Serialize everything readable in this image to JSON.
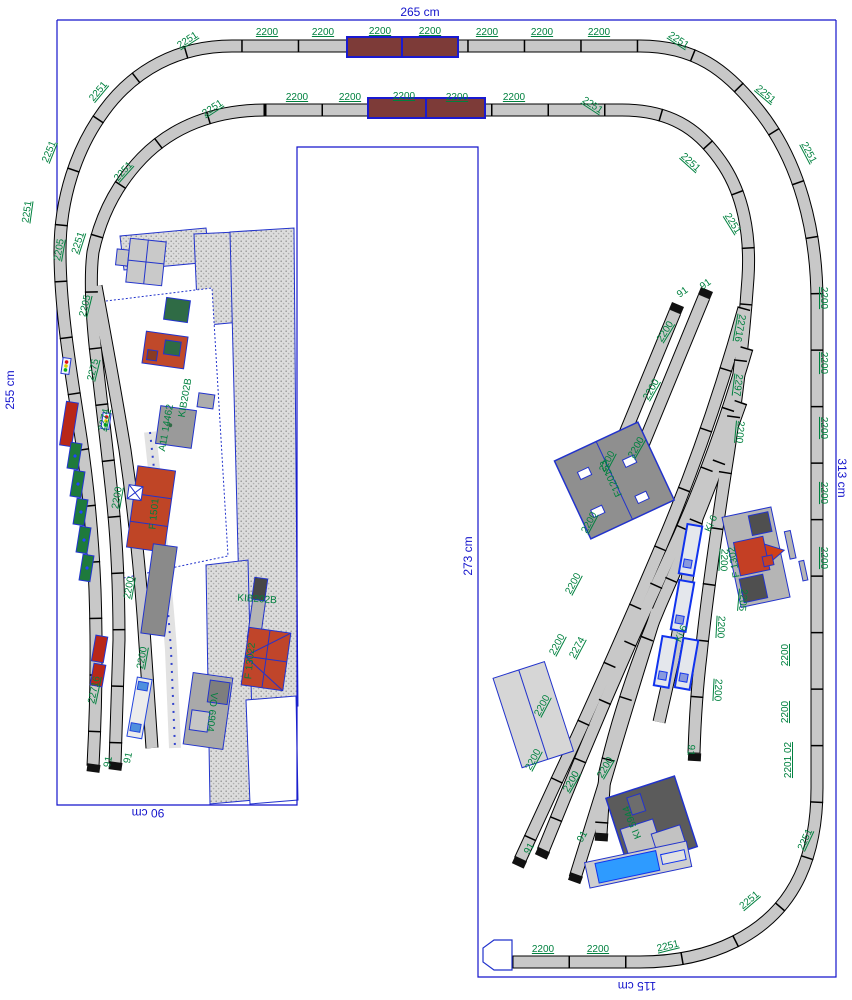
{
  "plan": {
    "name": "model-railroad-track-plan",
    "colors": {
      "border_blue": "#1414cc",
      "label_green": "#00813f",
      "track_gray": "#c8c8c8",
      "bridge_brown": "#7d3b38",
      "building_red": "#c0452a",
      "building_gray": "#9a9a9a",
      "building_dark": "#5b5b5b",
      "wagon_green": "#1e7a3c",
      "wagon_red": "#b92718",
      "loco_blue": "#2e9bff",
      "coach_outline_blue": "#1133ee"
    }
  },
  "dimensions": {
    "top": "265 cm",
    "left": "255 cm",
    "right": "313 cm",
    "bottom_left": "90 cm",
    "middle": "273 cm",
    "bottom": "115 cm"
  },
  "labels": [
    [
      "2200",
      267,
      33,
      0
    ],
    [
      "2200",
      323,
      33,
      0
    ],
    [
      "2200",
      380,
      32,
      0
    ],
    [
      "2200",
      430,
      32,
      0
    ],
    [
      "2200",
      487,
      33,
      0
    ],
    [
      "2200",
      542,
      33,
      0
    ],
    [
      "2200",
      599,
      33,
      0
    ],
    [
      "2251",
      188,
      41,
      -33
    ],
    [
      "2251",
      678,
      41,
      33
    ],
    [
      "2200",
      297,
      98,
      0
    ],
    [
      "2200",
      350,
      98,
      0
    ],
    [
      "2200",
      404,
      97,
      0
    ],
    [
      "2200",
      457,
      98,
      0
    ],
    [
      "2200",
      514,
      98,
      0
    ],
    [
      "2251",
      213,
      109,
      -33
    ],
    [
      "2251",
      592,
      106,
      33
    ],
    [
      "2251",
      99,
      92,
      -50
    ],
    [
      "2251",
      50,
      152,
      -68
    ],
    [
      "2251",
      28,
      212,
      -82
    ],
    [
      "2205",
      60,
      250,
      -80
    ],
    [
      "2251",
      79,
      243,
      -72
    ],
    [
      "2251",
      124,
      172,
      -48
    ],
    [
      "2205",
      86,
      306,
      -76
    ],
    [
      "2275",
      94,
      370,
      -76
    ],
    [
      "2274",
      105,
      420,
      -78
    ],
    [
      "2200",
      118,
      498,
      -80
    ],
    [
      "2200",
      130,
      588,
      -80
    ],
    [
      "2200",
      143,
      658,
      -80
    ],
    [
      "22716",
      95,
      690,
      -78
    ],
    [
      "91",
      109,
      762,
      -78
    ],
    [
      "91",
      129,
      758,
      -78
    ],
    [
      "2251",
      765,
      95,
      40
    ],
    [
      "2251",
      808,
      153,
      62
    ],
    [
      "2251",
      690,
      163,
      42
    ],
    [
      "2251",
      732,
      224,
      58
    ],
    [
      "2200",
      823,
      298,
      90
    ],
    [
      "2200",
      823,
      363,
      90
    ],
    [
      "2200",
      823,
      428,
      90
    ],
    [
      "2200",
      823,
      493,
      90
    ],
    [
      "2200",
      823,
      558,
      90
    ],
    [
      "2200",
      786,
      655,
      -90
    ],
    [
      "2200",
      786,
      712,
      -90
    ],
    [
      "2201 02",
      789,
      760,
      -90
    ],
    [
      "22716",
      739,
      328,
      100
    ],
    [
      "2297",
      737,
      385,
      97
    ],
    [
      "2200",
      739,
      432,
      95
    ],
    [
      "2200",
      723,
      560,
      93
    ],
    [
      "2200",
      720,
      627,
      93
    ],
    [
      "2200",
      717,
      690,
      93
    ],
    [
      "2205",
      742,
      600,
      95
    ],
    [
      "2200",
      666,
      332,
      -58
    ],
    [
      "2200",
      652,
      390,
      -60
    ],
    [
      "2200",
      637,
      448,
      -60
    ],
    [
      "2200",
      608,
      462,
      -62
    ],
    [
      "2200",
      590,
      523,
      -62
    ],
    [
      "2200",
      574,
      584,
      -62
    ],
    [
      "2200",
      558,
      645,
      -62
    ],
    [
      "2200",
      543,
      706,
      -62
    ],
    [
      "2200",
      534,
      760,
      -62
    ],
    [
      "2200",
      572,
      782,
      -60
    ],
    [
      "2200",
      606,
      768,
      -60
    ],
    [
      "2274",
      578,
      648,
      -62
    ],
    [
      "91",
      683,
      293,
      -35
    ],
    [
      "91",
      706,
      285,
      -35
    ],
    [
      "91",
      690,
      750,
      95
    ],
    [
      "91",
      530,
      849,
      -60
    ],
    [
      "91",
      583,
      837,
      -60
    ],
    [
      "2200",
      543,
      950,
      0
    ],
    [
      "2200",
      598,
      950,
      0
    ],
    [
      "2251",
      668,
      947,
      -14
    ],
    [
      "2251",
      750,
      901,
      -40
    ],
    [
      "2251",
      806,
      840,
      -65
    ],
    [
      "Ki 6",
      712,
      524,
      -66
    ],
    [
      "Ki 6",
      682,
      634,
      -66
    ],
    [
      "KIB202B",
      257,
      600,
      4
    ],
    [
      "KIB202B",
      186,
      398,
      -80
    ],
    [
      "A11 14462",
      167,
      428,
      -80
    ],
    [
      "F 1501",
      155,
      514,
      -84
    ],
    [
      "F 13022",
      251,
      661,
      -84
    ],
    [
      "VO 6904",
      211,
      712,
      96
    ],
    [
      "F120153",
      612,
      478,
      -115
    ],
    [
      "KI 5944",
      633,
      822,
      -112
    ],
    [
      "F 1302",
      735,
      562,
      -100
    ]
  ]
}
